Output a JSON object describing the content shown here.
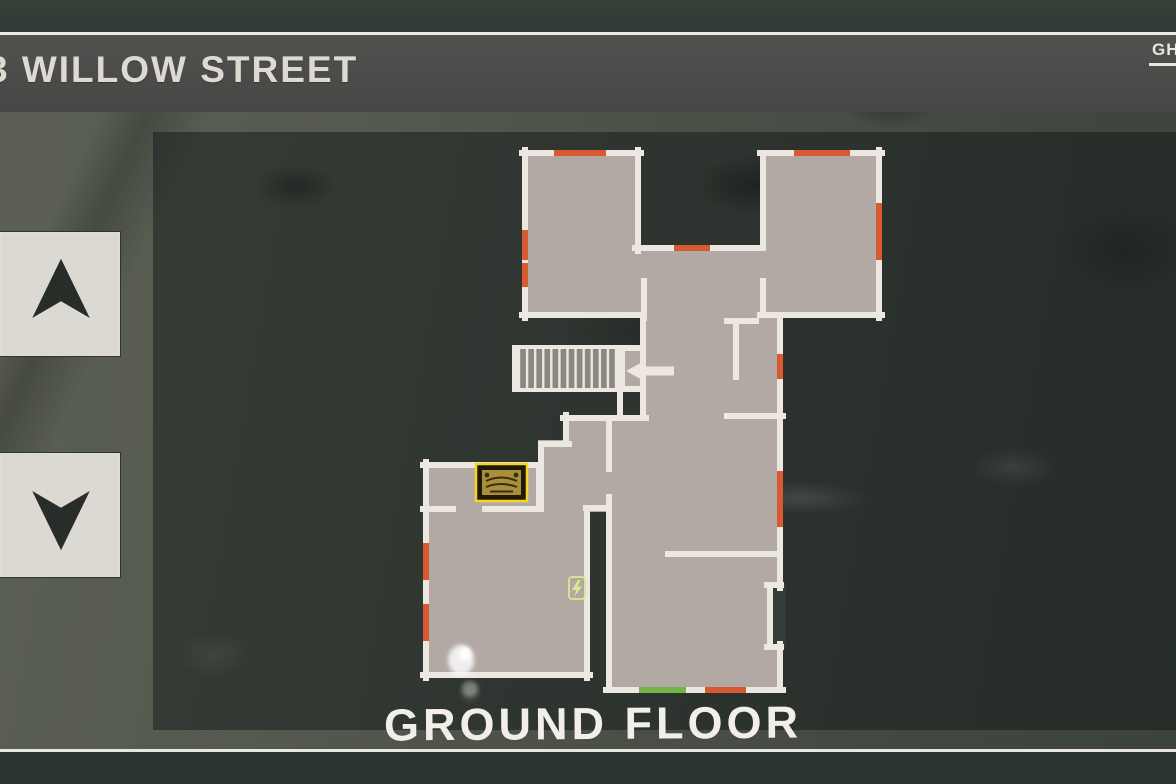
{
  "title_bar": {
    "title": "3 WILLOW STREET"
  },
  "header": {
    "top_right_tab": "GH"
  },
  "floor_nav": {
    "up_icon": "arrow-up-icon",
    "down_icon": "arrow-down-icon"
  },
  "map": {
    "floor_label": "GROUND FLOOR",
    "legend": {
      "orange_marker": "door",
      "green_marker": "exit-door",
      "board_icon": "ouija-board",
      "fuse_icon": "fuse-box",
      "arrow_icon": "stairs-direction-left"
    }
  },
  "floorplan": {
    "colors": {
      "room_fill": "#b2a9a5",
      "wall": "#ece8e1",
      "door": "#d85a33",
      "exit_door": "#72b548",
      "outside": "#343c39",
      "stair_bar": "#8d8781",
      "fuse_green": "#dbe98b",
      "board_frame": "#f2d621",
      "board_face": "#a98f3a"
    },
    "rooms": [
      [
        522,
        150,
        119,
        168
      ],
      [
        760,
        150,
        122,
        168
      ],
      [
        635,
        245,
        128,
        73
      ],
      [
        640,
        318,
        143,
        103
      ],
      [
        620,
        345,
        25,
        47
      ],
      [
        566,
        415,
        46,
        29
      ],
      [
        538,
        440,
        74,
        72
      ],
      [
        423,
        462,
        118,
        50
      ],
      [
        423,
        504,
        167,
        174
      ],
      [
        606,
        418,
        177,
        275
      ]
    ],
    "wall_notch": [
      773,
      585,
      13,
      62
    ],
    "walls": [
      [
        522,
        153,
        641,
        153
      ],
      [
        525,
        150,
        525,
        318
      ],
      [
        522,
        315,
        644,
        315
      ],
      [
        638,
        150,
        638,
        251
      ],
      [
        644,
        281,
        644,
        318
      ],
      [
        635,
        248,
        760,
        248
      ],
      [
        760,
        153,
        882,
        153
      ],
      [
        879,
        150,
        879,
        318
      ],
      [
        763,
        153,
        763,
        248
      ],
      [
        763,
        281,
        763,
        315
      ],
      [
        760,
        315,
        882,
        315
      ],
      [
        727,
        321,
        756,
        321
      ],
      [
        736,
        321,
        736,
        377
      ],
      [
        780,
        318,
        780,
        421
      ],
      [
        727,
        416,
        783,
        416
      ],
      [
        643,
        318,
        643,
        363
      ],
      [
        643,
        382,
        643,
        418
      ],
      [
        563,
        418,
        646,
        418
      ],
      [
        620,
        348,
        643,
        348
      ],
      [
        620,
        389,
        643,
        389
      ],
      [
        620,
        392,
        620,
        416
      ],
      [
        566,
        415,
        566,
        444
      ],
      [
        541,
        444,
        569,
        444
      ],
      [
        541,
        444,
        541,
        509
      ],
      [
        609,
        421,
        609,
        469
      ],
      [
        586,
        508,
        609,
        508
      ],
      [
        609,
        497,
        609,
        690
      ],
      [
        423,
        465,
        541,
        465
      ],
      [
        426,
        462,
        426,
        678
      ],
      [
        423,
        509,
        453,
        509
      ],
      [
        485,
        509,
        541,
        509
      ],
      [
        539,
        465,
        539,
        509
      ],
      [
        587,
        508,
        587,
        678
      ],
      [
        423,
        675,
        590,
        675
      ],
      [
        668,
        554,
        780,
        554
      ],
      [
        780,
        418,
        780,
        588
      ],
      [
        780,
        644,
        780,
        690
      ],
      [
        767,
        585,
        781,
        585
      ],
      [
        770,
        585,
        770,
        647
      ],
      [
        767,
        647,
        781,
        647
      ],
      [
        606,
        690,
        783,
        690
      ]
    ],
    "doors": [
      [
        557,
        153,
        603,
        153
      ],
      [
        525,
        233,
        525,
        257
      ],
      [
        525,
        266,
        525,
        284
      ],
      [
        677,
        248,
        707,
        248
      ],
      [
        797,
        153,
        847,
        153
      ],
      [
        879,
        206,
        879,
        257
      ],
      [
        780,
        357,
        780,
        376
      ],
      [
        780,
        474,
        780,
        524
      ],
      [
        426,
        546,
        426,
        577
      ],
      [
        426,
        607,
        426,
        638
      ],
      [
        708,
        690,
        743,
        690
      ]
    ],
    "exit_door": [
      642,
      690,
      683,
      690
    ],
    "stairs": {
      "frame": [
        512,
        345,
        113,
        47
      ],
      "bar_count": 12,
      "bar_x0": 519,
      "bar_x1": 616,
      "bar_y0": 349,
      "bar_y1": 388
    },
    "stairs_arrow": "M626,371 L646,360 L646,366.5 L674,366.5 L674,375.5 L646,375.5 L646,382 Z",
    "board": {
      "outer": [
        476,
        464,
        51,
        37
      ],
      "inner": [
        482,
        470,
        39,
        25
      ]
    },
    "fuse": {
      "box": [
        569,
        577,
        16,
        22
      ],
      "bolt": "M578,580 L572,590 L576.5,590 L574,597 L582,586.5 L577.5,586.5 L580.5,580 Z"
    },
    "salt": [
      [
        461,
        660,
        13,
        15,
        0.8
      ],
      [
        465,
        654,
        6,
        7,
        0.95
      ],
      [
        470,
        689,
        8,
        8,
        0.3
      ]
    ]
  }
}
